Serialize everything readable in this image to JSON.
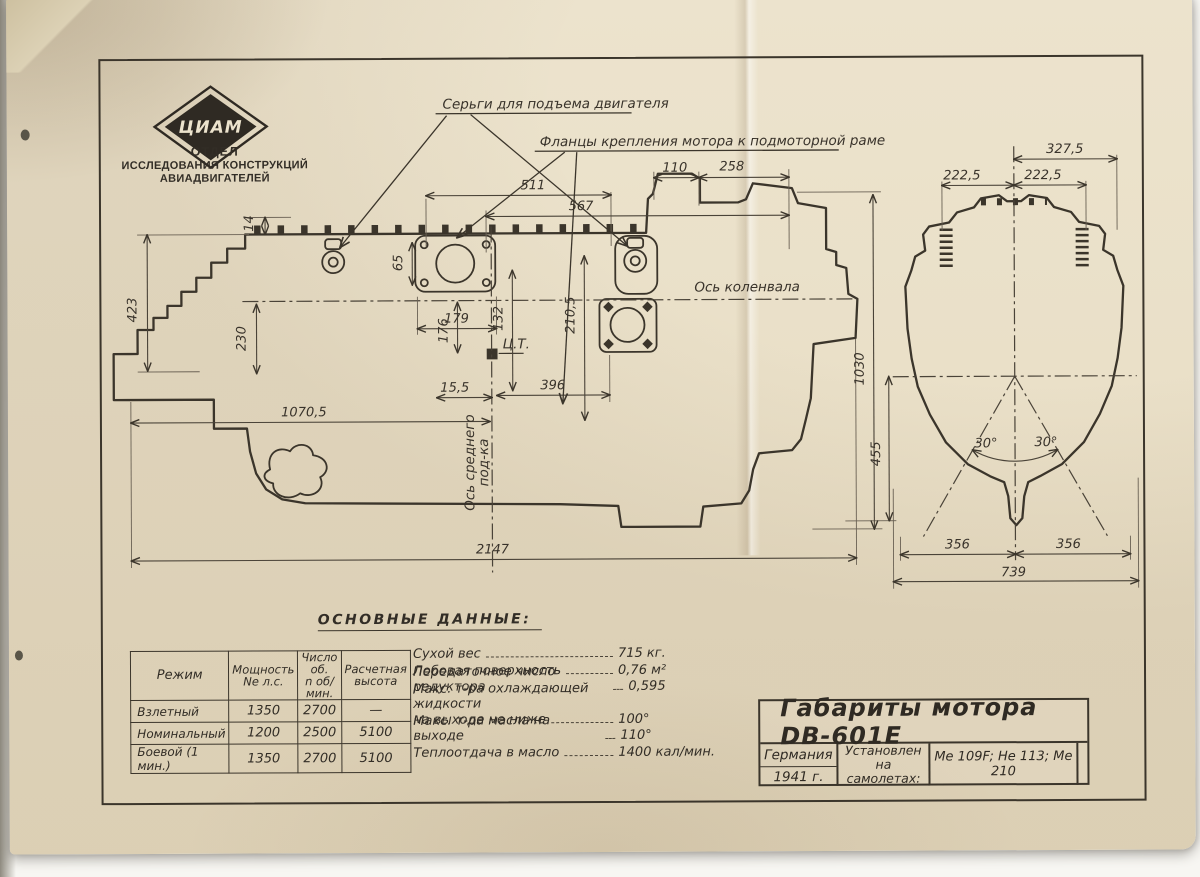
{
  "colors": {
    "paper": "#ece3cd",
    "ink": "#3b352b"
  },
  "org": {
    "logo": "ЦИАМ",
    "dept_line1": "ОТДЕЛ",
    "dept_line2": "ИССЛЕДОВАНИЯ КОНСТРУКЦИЙ",
    "dept_line3": "АВИАДВИГАТЕЛЕЙ"
  },
  "callouts": {
    "lugs": "Серьги для подъема двигателя",
    "flanges": "Фланцы крепления мотора к подмоторной раме"
  },
  "axes": {
    "crankshaft": "Ось коленвала",
    "mid_bearing_1": "Ось среднего",
    "mid_bearing_2": "под-ка",
    "cg": "Ц.Т."
  },
  "dims": {
    "v110": "110",
    "v258": "258",
    "v511": "511",
    "v567": "567",
    "v14": "14",
    "v423": "423",
    "v230": "230",
    "v179": "179",
    "v65": "65",
    "v132": "132",
    "v210_5": "210,5",
    "v176": "176",
    "v15_5": "15,5",
    "v396": "396",
    "v1070_5": "1070,5",
    "v2147": "2147",
    "v1030": "1030",
    "v455": "455",
    "v327_5": "327,5",
    "v222_5a": "222,5",
    "v222_5b": "222,5",
    "v30a": "30°",
    "v30b": "30°",
    "v356a": "356",
    "v356b": "356",
    "v739": "739"
  },
  "table": {
    "title": "ОСНОВНЫЕ  ДАННЫЕ:",
    "col0": "Режим",
    "col1a": "Мощность",
    "col1b": "Nе л.с.",
    "col2a": "Число об.",
    "col2b": "n об/мин.",
    "col3a": "Расчетная",
    "col3b": "высота",
    "rows": [
      [
        "Взлетный",
        "1350",
        "2700",
        "—"
      ],
      [
        "Номинальный",
        "1200",
        "2500",
        "5100"
      ],
      [
        "Боевой (1 мин.)",
        "1350",
        "2700",
        "5100"
      ]
    ]
  },
  "specs": {
    "items": [
      {
        "label": "Сухой вес",
        "value": "715 кг."
      },
      {
        "label": "Лобовая поверхность",
        "value": "0,76 м²"
      },
      {
        "label": "Передаточное число редуктора",
        "value": "0,595"
      },
      {
        "label": "Макс. т-ра охлаждающей жидкости",
        "value": ""
      },
      {
        "label": "на выходе не ниже",
        "value": "100°"
      },
      {
        "label": "Макс. т-ра масла на выходе",
        "value": "110°"
      },
      {
        "label": "Теплоотдача в масло",
        "value": "1400 кал/мин."
      }
    ]
  },
  "title_block": {
    "title": "Габариты мотора DB-601E",
    "country": "Германия",
    "year": "1941 г.",
    "installed_1": "Установлен",
    "installed_2": "на самолетах:",
    "aircraft": "Me 109F; He 113; Me 210"
  }
}
